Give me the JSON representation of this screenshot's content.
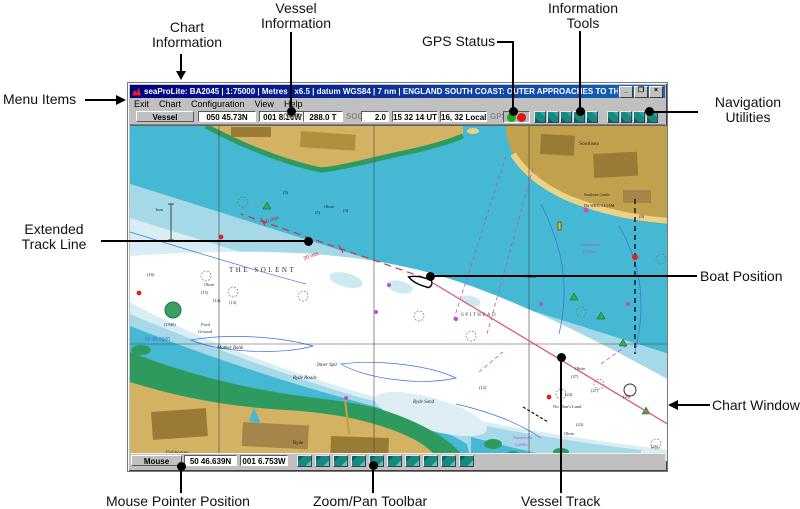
{
  "annotations": {
    "chart_information": "Chart\nInformation",
    "vessel_information": "Vessel\nInformation",
    "gps_status": "GPS Status",
    "information_tools": "Information\nTools",
    "menu_items": "Menu Items",
    "navigation_utilities": "Navigation\nUtilities",
    "extended_track_line": "Extended\nTrack Line",
    "boat_position": "Boat Position",
    "chart_window": "Chart Window",
    "mouse_pointer_position": "Mouse Pointer Position",
    "zoom_pan_toolbar": "Zoom/Pan Toolbar",
    "vessel_track": "Vessel Track"
  },
  "window": {
    "title": "seaProLite: BA2045 | 1:75000 | Metres | x6.5 | datum WGS84 | 7 nm | ENGLAND SOUTH COAST: OUTER APPROACHES TO THE SOLENT - [BA2045 | 1:75000 | Met...",
    "buttons": {
      "minimize": "_",
      "restore": "❐",
      "close": "×"
    },
    "menu": [
      "Exit",
      "Chart",
      "Configuration",
      "View",
      "Help"
    ],
    "toolbar": {
      "vessel_label": "Vessel",
      "latitude": "050 45.73N",
      "longitude": "001 8.16W",
      "cog_label": "COG",
      "course": "288.0 T",
      "sog_label": "SOG",
      "speed": "2.0",
      "utc_time": "15 32 14 UT",
      "local_time": "16, 32 Local",
      "gps_label": "GPS",
      "gps_light_ok_color": "#18a818",
      "gps_light_alarm_color": "#d81818",
      "information_tools_count": 5,
      "navigation_utilities_count": 4
    },
    "statusbar": {
      "mouse_label": "Mouse",
      "latitude": "50 46.639N",
      "longitude": "001 6.753W",
      "zoom_pan_buttons_count": 10
    }
  },
  "chart": {
    "labels": {
      "the_solent": "THE SOLENT",
      "spithead": "SPITHEAD",
      "mother_bank": "Mother Bank",
      "inner_spit": "Inner Spit",
      "ryde_roads": "Ryde Roads",
      "ryde_sand": "Ryde Sand",
      "ryde": "Ryde",
      "fishbourne": "Fishbourne",
      "ford_1": "Ford",
      "ford_2": "Ground",
      "no_mans_land": "No Man's Land",
      "southsea": "Southsea",
      "castle": "Southsea Castle",
      "light_char": "Dir WRG 3.13-5M",
      "cables_1": "Numerous",
      "cables_2": "Cables",
      "obstn": "Obstn",
      "wreck_year": "(1946)",
      "grid_latitude": "50 45.0000",
      "scale": "1nm",
      "min30": "30 min",
      "min60": "60 min"
    },
    "depths": [
      "(16)",
      "(15)",
      "(14)",
      "(13)",
      "(5)",
      "(5)",
      "(5)",
      "(8)",
      "(12)",
      "(27)",
      "(24)",
      "(27)",
      "(24)",
      "(23)",
      "(26)"
    ],
    "colors": {
      "deep_water": "#45b8d3",
      "medium_water": "#a5d9e7",
      "shallow_water": "#d8eef4",
      "channel_white": "#ffffff",
      "land": "#d4b264",
      "land_dark": "#9a7b35",
      "beach": "#ecd287",
      "intertidal_green": "#2f9a5d",
      "track_pink": "#e05575",
      "extended_track_red": "#cc3344",
      "magenta_symbols": "#c050c0",
      "contour_blue": "#3a6fd8"
    }
  }
}
